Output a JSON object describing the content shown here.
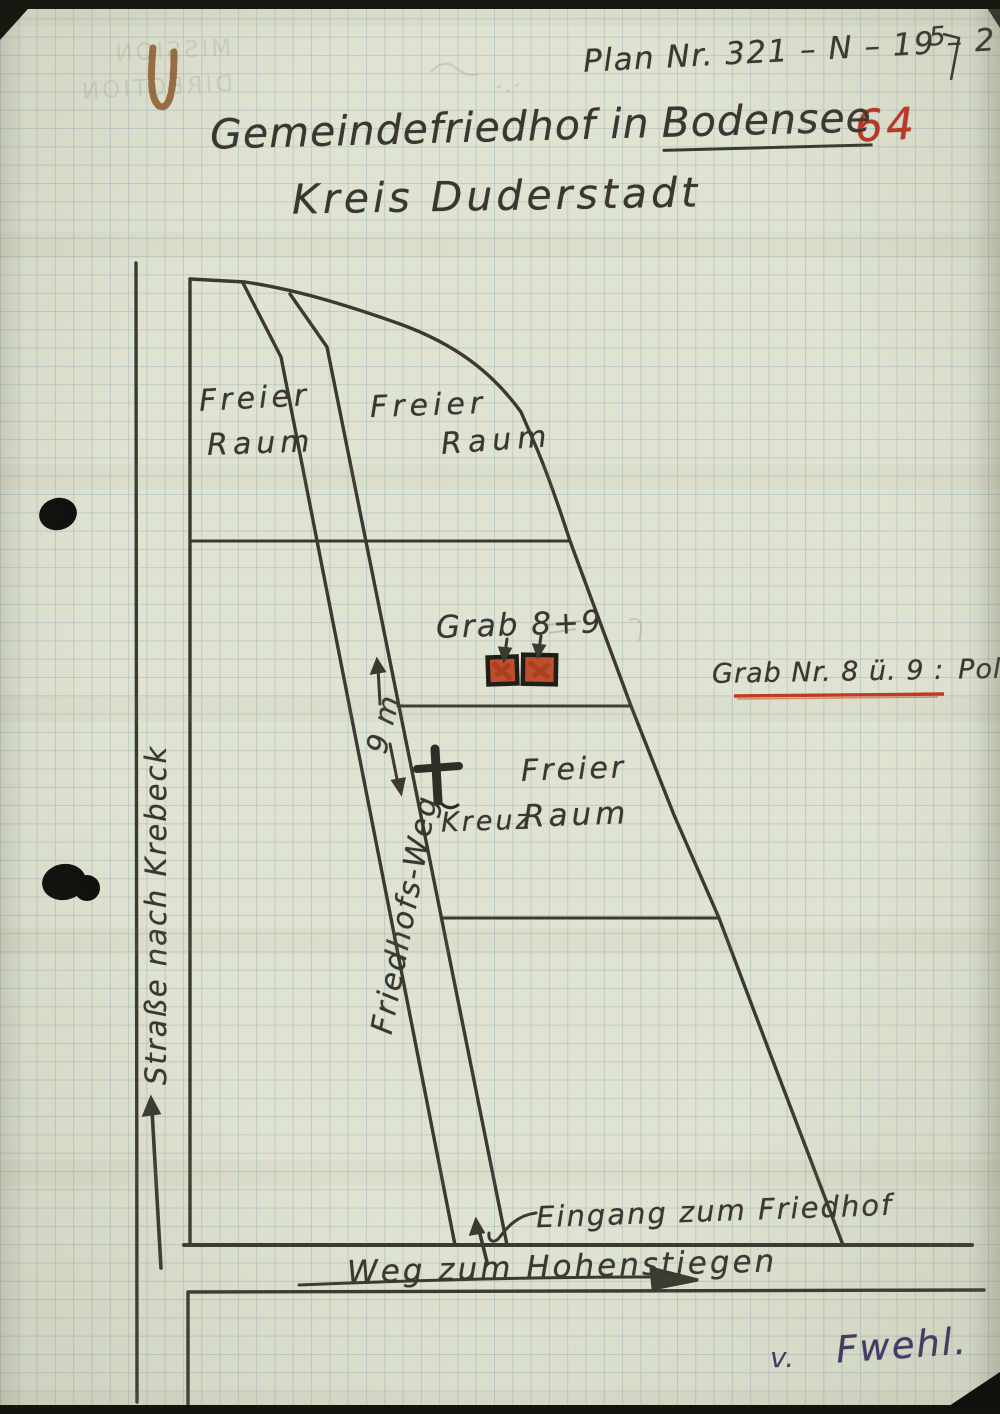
{
  "document": {
    "plan_number": "Plan Nr. 321 – N – 19 – 2",
    "plan_corner_mark": "5",
    "folio_number": "64",
    "title_prefix": "Gemeindefriedhof in",
    "title_place": "Bodensee",
    "subtitle": "Kreis Duderstadt",
    "bleedthrough": {
      "line1": "MISSION",
      "line2": "DIRECTION"
    },
    "signature": {
      "initial": "v.",
      "name": "Fwehl."
    }
  },
  "map": {
    "labels": {
      "area_top_left_line1": "Freier",
      "area_top_left_line2": "Raum",
      "area_top_right_line1": "Freier",
      "area_top_right_line2": "Raum",
      "area_middle_line1": "Freier",
      "area_middle_line2": "Raum",
      "graves": "Grab 8+9",
      "grave_note_label": "Grab Nr. 8 ü. 9 :",
      "grave_note_value": "Polen",
      "cross": "Kreuz",
      "path": "Friedhofs-Weg",
      "path_width": "9 m",
      "road_left": "Straße nach Krebeck",
      "entrance": "Eingang zum Friedhof",
      "road_bottom": "Weg zum Hohenstiegen"
    },
    "colors": {
      "paper": "#e0e3d1",
      "grid_line": "#9fc0cb",
      "ink": "#3a3a31",
      "red_ink": "#bb3526",
      "grave_fill": "#bf4f2c",
      "signature_ink": "#3d3766",
      "rust_stain": "#8a4f1e"
    }
  }
}
